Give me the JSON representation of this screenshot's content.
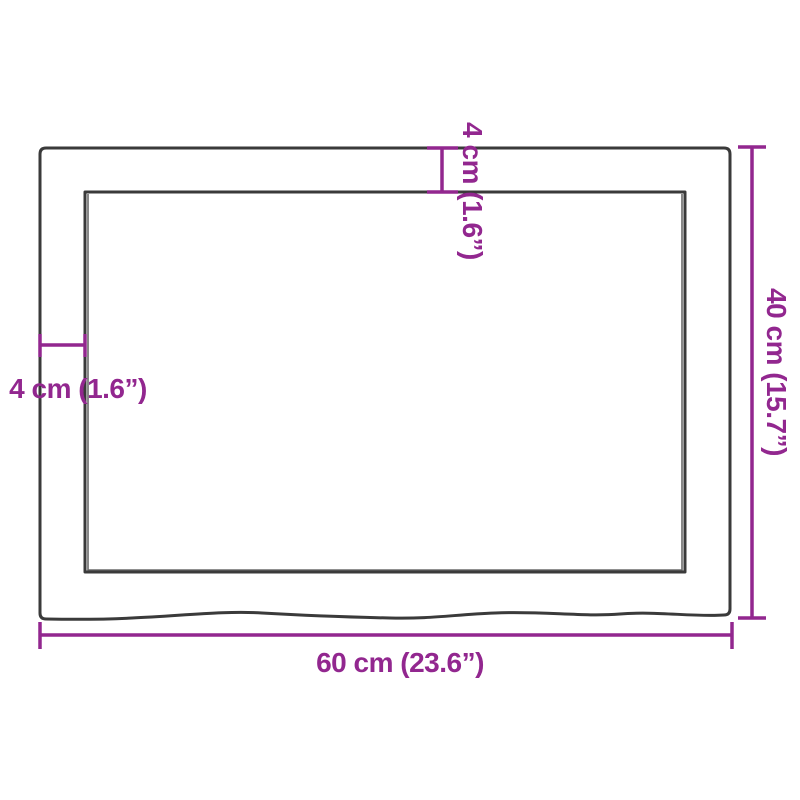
{
  "diagram": {
    "kind": "product-dimension-diagram",
    "labels": {
      "width": "60 cm (23.6”)",
      "height": "40 cm (15.7”)",
      "thickness_top": "4 cm (1.6”)",
      "thickness_left": "4 cm (1.6”)"
    }
  },
  "colors": {
    "dimension": "#92278F",
    "outline": "#3A3A3A",
    "background": "#FFFFFF"
  }
}
